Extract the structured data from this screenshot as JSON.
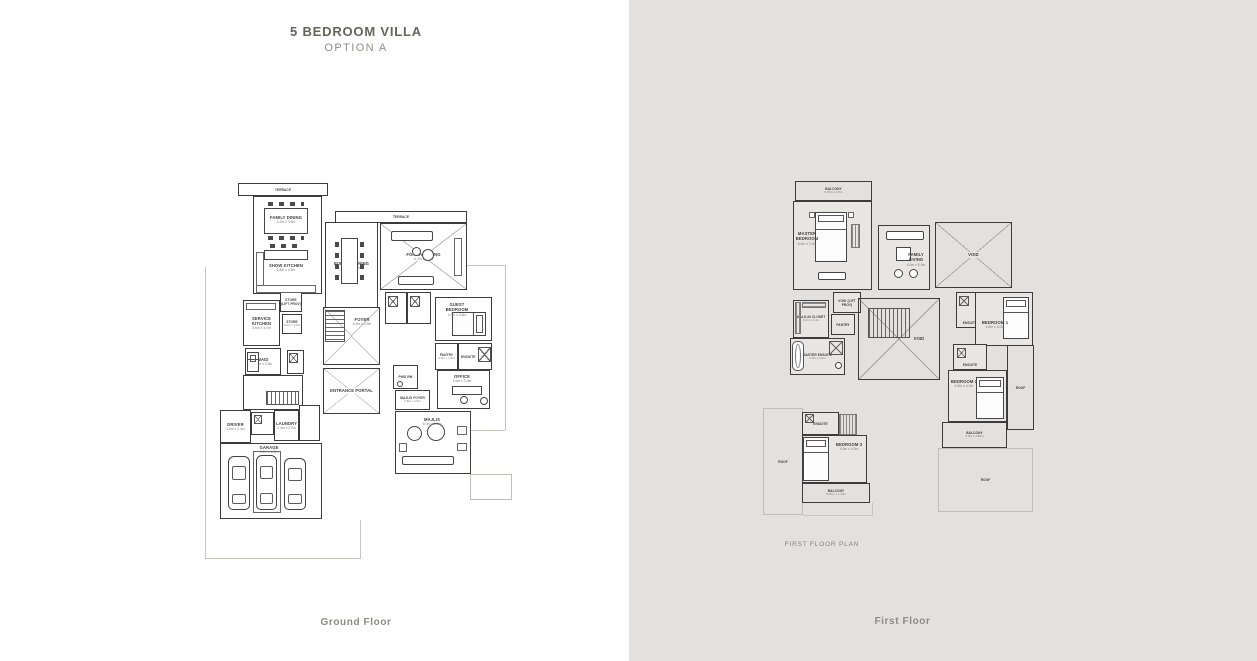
{
  "title": {
    "line1": "5 BEDROOM VILLA",
    "line2": "OPTION A"
  },
  "colors": {
    "right_panel_bg": "#e3e1dd",
    "wall_line": "#3c3c3c",
    "title_text": "#64645d",
    "caption_text": "#8c8c85",
    "plot_line": "#c6c4bf"
  },
  "ground": {
    "caption": "Ground Floor",
    "rooms": {
      "terrace_left": {
        "label": "TERRACE"
      },
      "terrace_right": {
        "label": "TERRACE"
      },
      "family_dining": {
        "label": "FAMILY DINING",
        "dim": "4.2m x 3.6m"
      },
      "show_kitchen": {
        "label": "SHOW KITCHEN",
        "dim": "5.8m x 4.5m"
      },
      "formal_dining": {
        "label": "FORMAL DINING",
        "dim": "5.6m x 3.8m"
      },
      "formal_living": {
        "label": "FORMAL LIVING",
        "dim": "6.2m x 5.6m"
      },
      "guest_bedroom": {
        "label": "GUEST BEDROOM",
        "dim": "4.0m x 3.6m"
      },
      "foyer": {
        "label": "FOYER",
        "dim": "5.4m x 4.5m"
      },
      "entrance_portal": {
        "label": "ENTRANCE PORTAL"
      },
      "store_lift": {
        "label": "STORE (LIFT PROV)"
      },
      "service_kitchen": {
        "label": "SERVICE KITCHEN",
        "dim": "3.6m x 3.0m"
      },
      "store": {
        "label": "STORE",
        "dim": "2.0m x 1.6m"
      },
      "maid": {
        "label": "MAID",
        "dim": "3.0m x 2.6m"
      },
      "pantry": {
        "label": "PANTRY",
        "dim": "2.0m x 1.8m"
      },
      "ensuite_guest": {
        "label": "ENSUITE"
      },
      "office": {
        "label": "OFFICE",
        "dim": "3.6m x 3.0m"
      },
      "pwd_rm": {
        "label": "PWD RM"
      },
      "majlis_foyer": {
        "label": "MAJLIS FOYER",
        "dim": "2.8m x 1.8m"
      },
      "driver": {
        "label": "DRIVER",
        "dim": "3.0m x 2.4m"
      },
      "laundry": {
        "label": "LAUNDRY",
        "dim": "2.4m x 2.0m"
      },
      "garage": {
        "label": "GARAGE",
        "dim": "8.0m x 6.2m"
      },
      "majlis": {
        "label": "MAJLIS",
        "dim": "6.0m x 5.0m"
      }
    }
  },
  "first": {
    "caption": "First Floor",
    "plan_label": "FIRST FLOOR PLAN",
    "rooms": {
      "balcony_top": {
        "label": "BALCONY",
        "dim": "5.70m x 1.5m"
      },
      "master_bedroom": {
        "label": "MASTER BEDROOM",
        "dim": "5.0m x 7.0m"
      },
      "family_living": {
        "label": "FAMILY LIVING",
        "dim": "4.0m x 5.0m"
      },
      "void_tr": {
        "label": "VOID"
      },
      "void_lift": {
        "label": "VOID (LIFT PROV)"
      },
      "walkin_closet": {
        "label": "WALK-IN CLOSET",
        "dim": "3.0m x 2.4m"
      },
      "pantry": {
        "label": "PANTRY"
      },
      "master_ensuite": {
        "label": "MASTER ENSUITE",
        "dim": "4.5m x 3.0m"
      },
      "void_center": {
        "label": "VOID"
      },
      "ensuite_1": {
        "label": "ENSUITE"
      },
      "bedroom_1": {
        "label": "BEDROOM 1",
        "dim": "4.5m x 4.0m"
      },
      "ensuite_2": {
        "label": "ENSUITE"
      },
      "bedroom_2": {
        "label": "BEDROOM 2",
        "dim": "4.5m x 4.0m"
      },
      "roof_right": {
        "label": "ROOF"
      },
      "balcony_2": {
        "label": "BALCONY",
        "dim": "5.0m x 1.85m"
      },
      "roof_bottom": {
        "label": "ROOF"
      },
      "ensuite_3": {
        "label": "ENSUITE"
      },
      "bedroom_3": {
        "label": "BEDROOM 3",
        "dim": "4.5m x 4.0m"
      },
      "balcony_left": {
        "label": "BALCONY",
        "dim": "5.00m x 1.70m"
      },
      "roof_left": {
        "label": "ROOF"
      }
    }
  }
}
